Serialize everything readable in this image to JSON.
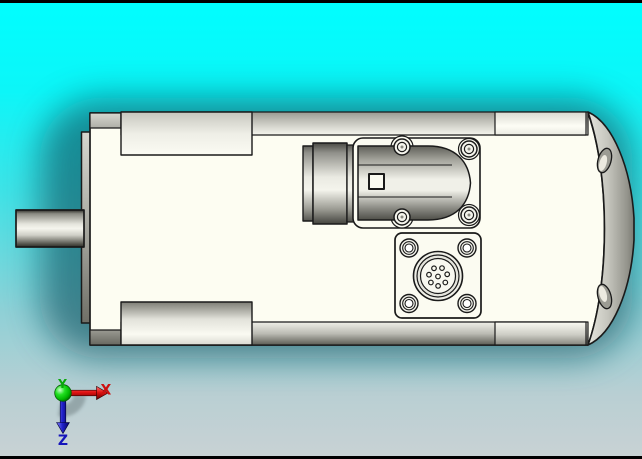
{
  "viewport": {
    "background_top_color": "#00feff",
    "background_bottom_color": "#c9d2d4",
    "shadow_halo_color": "#0e515e",
    "frame_color": "#000000"
  },
  "model": {
    "body_color": "#fdfdf2",
    "metal_color": "#b9b9b1",
    "outline_color": "#1a1a1a"
  },
  "triad": {
    "axes": [
      {
        "label": "X",
        "color": "#cc1111"
      },
      {
        "label": "Y",
        "color": "#0aa80a"
      },
      {
        "label": "Z",
        "color": "#1515bb"
      }
    ]
  }
}
